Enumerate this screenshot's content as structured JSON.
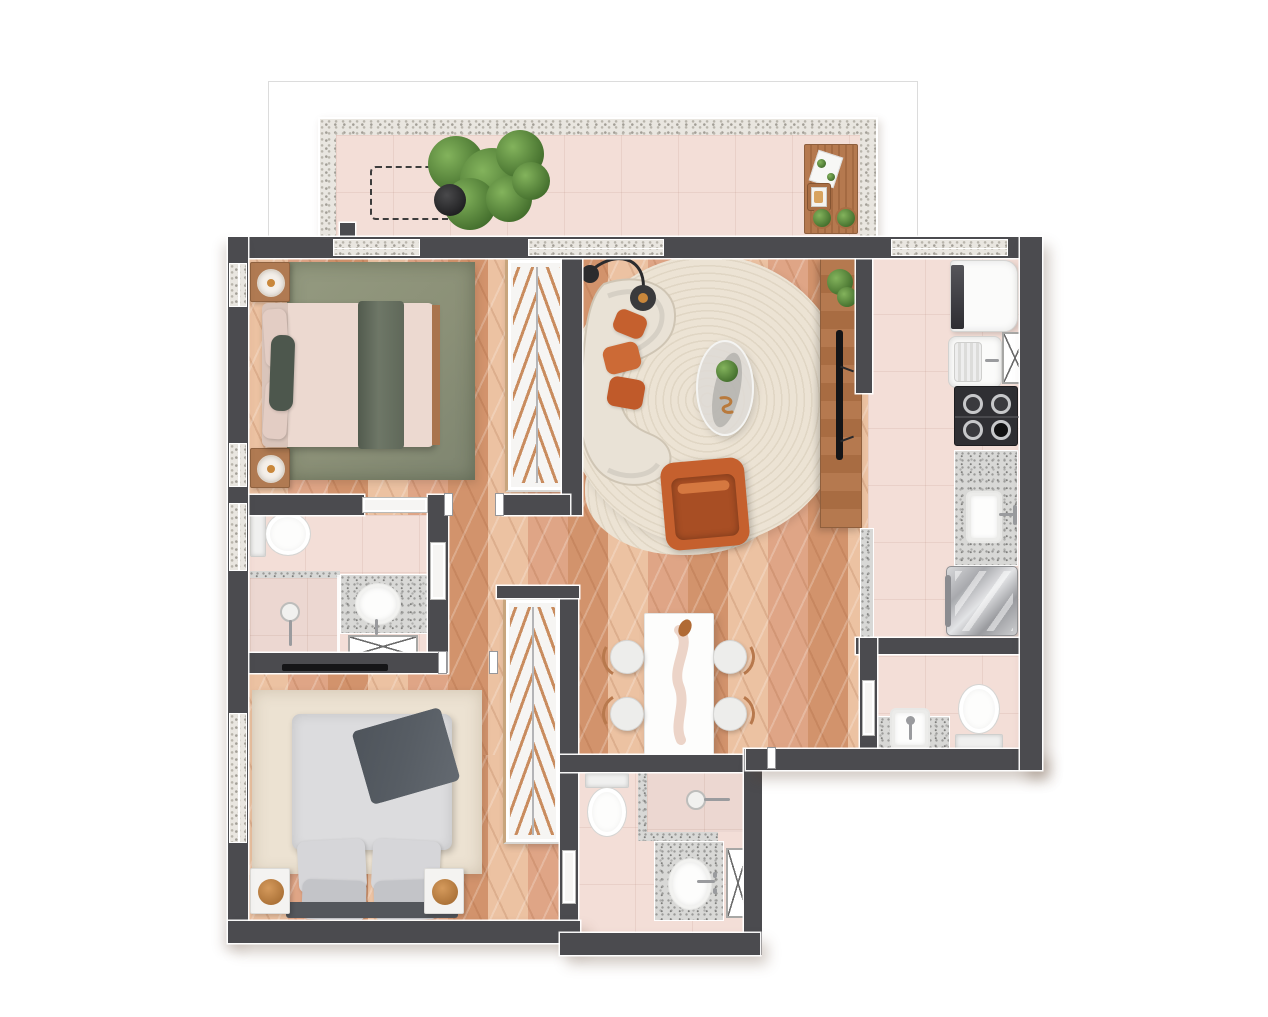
{
  "canvas": {
    "width": 1268,
    "height": 1017,
    "background_color": "#ffffff"
  },
  "palette": {
    "wall": "#4b4b4f",
    "wood": "#dfa586",
    "wood_light": "#ecc2a2",
    "wood_dark": "#d2936c",
    "tile": "#f3ded7",
    "stone": "#e9e6e0",
    "granite_base": "#d8d8d6",
    "rug_green": "#8b9077",
    "rug_cream": "#ece2d2",
    "sofa": "#e9e2d6",
    "orange": "#c5602e",
    "bed1_duvet": "#ecd9d0",
    "bed1_throw": "#5f6859",
    "bed2_duvet": "#dcdcde",
    "bed2_throw": "#575d64",
    "plant_light": "#83b35c",
    "plant_dark": "#446f2d",
    "rod": "#c98c5e"
  },
  "floor_plan": {
    "type": "apartment-top-view-render",
    "rooms": [
      {
        "name": "balcony",
        "floor": "tile",
        "furniture": [
          "planned-equipment-dashed-outline",
          "potted-tree",
          "wood-table-with-seat",
          "plant-pots"
        ]
      },
      {
        "name": "bedroom-1",
        "floor": "wood",
        "furniture": [
          "double-bed-green-throw",
          "nightstand-with-lamp",
          "nightstand-with-lamp",
          "green-area-rug",
          "wardrobe-with-hangers"
        ]
      },
      {
        "name": "living-room",
        "floor": "wood",
        "furniture": [
          "curved-sofa",
          "orange-throw-pillows",
          "arc-floor-lamp",
          "round-rug",
          "oval-coffee-table",
          "orange-armchair",
          "tv-console",
          "television",
          "potted-plant"
        ]
      },
      {
        "name": "dining-area",
        "floor": "wood",
        "furniture": [
          "dining-table",
          "chair",
          "chair",
          "chair",
          "chair",
          "table-runner"
        ]
      },
      {
        "name": "kitchen-service-area",
        "floor": "tile",
        "furniture": [
          "refrigerator",
          "laundry-tank",
          "utility-shaft",
          "gas-cooktop",
          "granite-counter-with-sink",
          "washing-machine"
        ]
      },
      {
        "name": "bathroom-1",
        "floor": "tile",
        "furniture": [
          "toilet",
          "shower",
          "granite-vanity-with-round-sink",
          "utility-shaft"
        ]
      },
      {
        "name": "bedroom-2",
        "floor": "wood",
        "furniture": [
          "double-bed-gray-throw",
          "nightstand-with-lamp",
          "nightstand-with-lamp",
          "cream-area-rug",
          "wardrobe-with-hangers",
          "wall-mounted-tv"
        ]
      },
      {
        "name": "bathroom-2",
        "floor": "tile",
        "furniture": [
          "toilet",
          "shower",
          "granite-vanity-with-oval-sink",
          "utility-shaft"
        ]
      },
      {
        "name": "service-wc",
        "floor": "tile",
        "furniture": [
          "toilet",
          "granite-ledge-with-square-sink"
        ]
      }
    ]
  }
}
